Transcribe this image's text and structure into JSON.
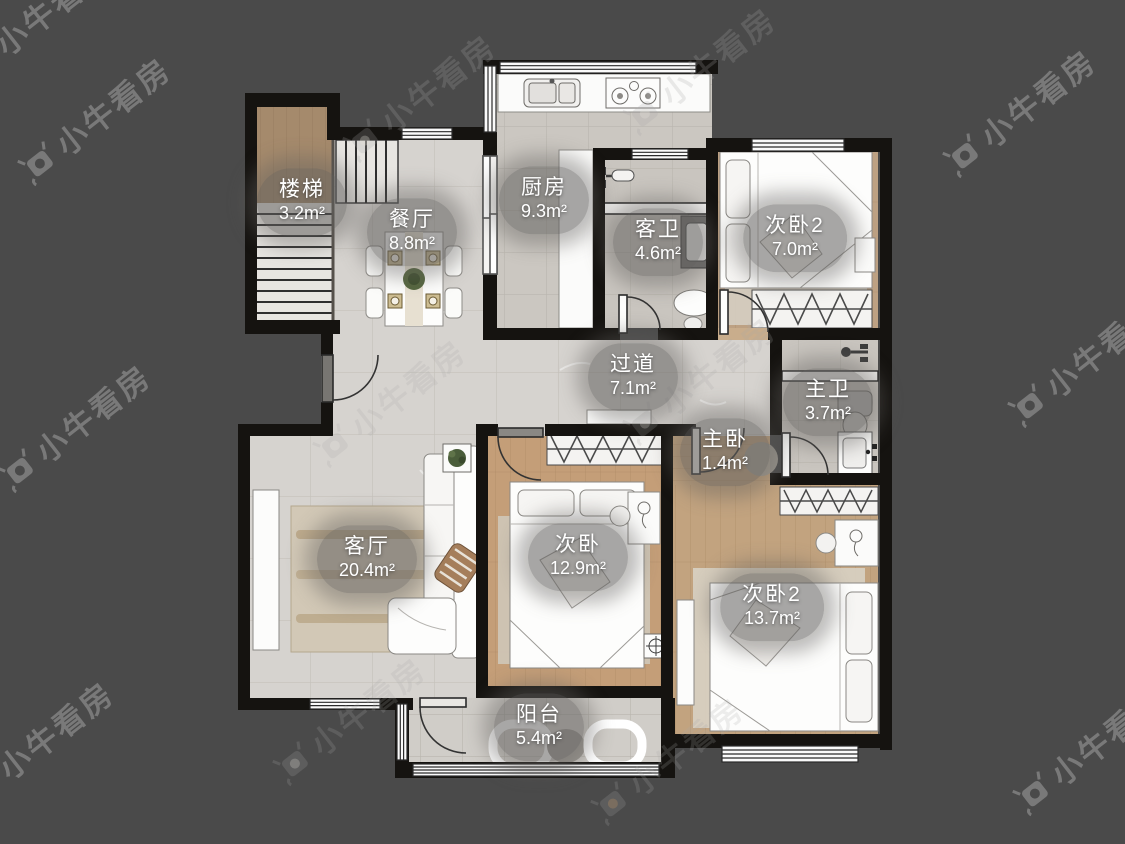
{
  "watermark": {
    "brand_text": "小牛看房"
  },
  "plan": {
    "type": "apartment-floor-plan",
    "rooms": [
      {
        "id": "stairs",
        "name": "楼梯",
        "area": "3.2m²"
      },
      {
        "id": "dining",
        "name": "餐厅",
        "area": "8.8m²"
      },
      {
        "id": "kitchen",
        "name": "厨房",
        "area": "9.3m²"
      },
      {
        "id": "guest-bath",
        "name": "客卫",
        "area": "4.6m²"
      },
      {
        "id": "bedroom2-top",
        "name": "次卧2",
        "area": "7.0m²"
      },
      {
        "id": "hallway",
        "name": "过道",
        "area": "7.1m²"
      },
      {
        "id": "master-bath",
        "name": "主卫",
        "area": "3.7m²"
      },
      {
        "id": "master-bedroom",
        "name": "主卧",
        "area": "1.4m²"
      },
      {
        "id": "living",
        "name": "客厅",
        "area": "20.4m²"
      },
      {
        "id": "bedroom",
        "name": "次卧",
        "area": "12.9m²"
      },
      {
        "id": "bedroom2-bottom",
        "name": "次卧2",
        "area": "13.7m²"
      },
      {
        "id": "balcony",
        "name": "阳台",
        "area": "5.4m²"
      }
    ],
    "furniture_icons": [
      "bed-icon",
      "wardrobe-icon",
      "dining-table-icon",
      "sofa-icon",
      "toilet-icon",
      "sink-icon",
      "stove-icon",
      "kitchen-sink-icon",
      "stairs-icon",
      "door-arc-icon",
      "window-icon",
      "rug-icon",
      "plant-icon",
      "desk-icon",
      "tv-stand-icon",
      "washbasin-icon"
    ]
  },
  "colors": {
    "background": "#4a4a4a",
    "wall": "#151310",
    "marble_floor": "#d6d3cf",
    "tile_floor": "#cbc7c1",
    "wood_floor": "#c2a37f",
    "stair_wood": "#a58a6c",
    "label_bg": "rgba(97,95,93,0.55)",
    "label_text": "#ffffff",
    "watermark": "rgba(168,168,168,0.5)"
  }
}
